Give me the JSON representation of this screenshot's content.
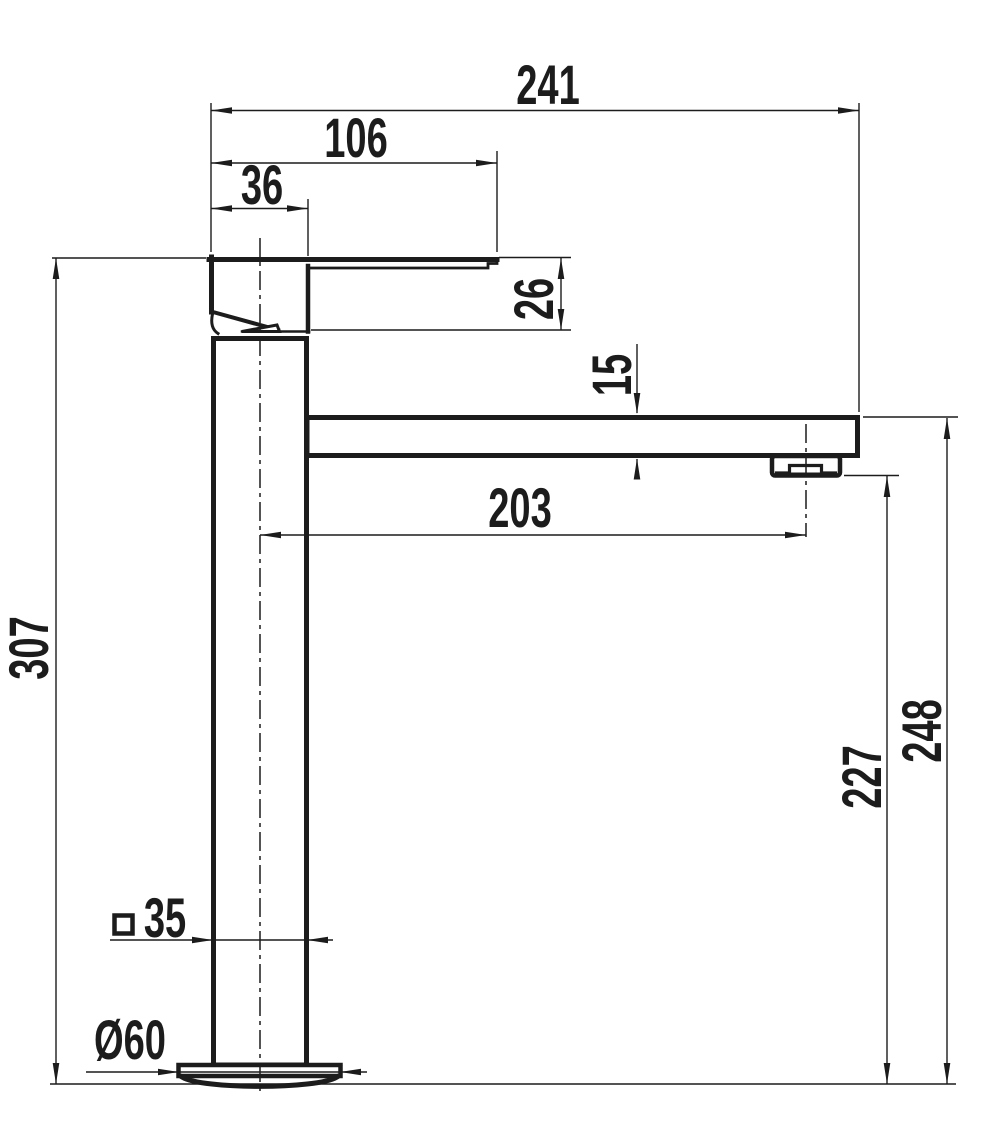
{
  "drawing": {
    "title": "faucet-dimension-drawing",
    "background": "#ffffff",
    "line_color": "#1c1c1c",
    "units_implied": "mm",
    "labels": {
      "d241": "241",
      "d106": "106",
      "d36": "36",
      "d26": "26",
      "d15": "15",
      "d203": "203",
      "d307": "307",
      "d227": "227",
      "d248": "248",
      "d35": "35",
      "d60": "Ø60"
    }
  }
}
